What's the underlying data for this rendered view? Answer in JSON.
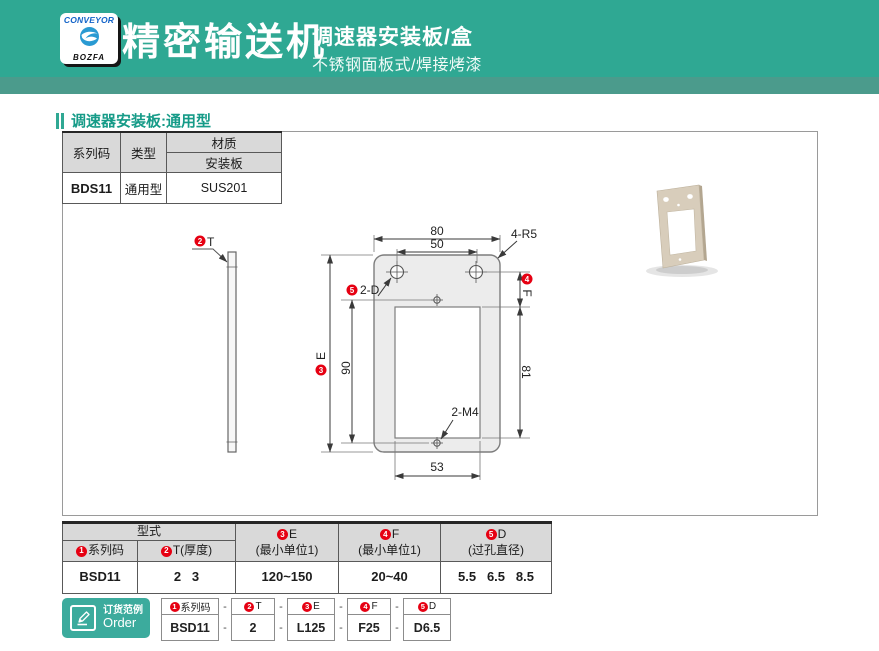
{
  "header": {
    "logo_top": "CONVEYOR",
    "logo_bottom": "BOZFA",
    "title": "精密输送机",
    "subtitle": "调速器安装板/盒",
    "tagline": "不锈钢面板式/焊接烤漆"
  },
  "section_title": "调速器安装板:通用型",
  "spec_table": {
    "h_series": "系列码",
    "h_type": "类型",
    "h_material": "材质",
    "h_plate": "安装板",
    "series": "BDS11",
    "type": "通用型",
    "material": "SUS201"
  },
  "drawing": {
    "t_num": "2",
    "t_label": "T",
    "dim80": "80",
    "dim50": "50",
    "corner": "4-R5",
    "d_num": "5",
    "d_label": "2-D",
    "e_num": "3",
    "e_label": "E",
    "f_num": "4",
    "f_label": "F",
    "dim90": "90",
    "dim81": "81",
    "thread": "2-M4",
    "dim53": "53"
  },
  "model_table": {
    "group": "型式",
    "columns": [
      {
        "num": "1",
        "label": "系列码",
        "sub": ""
      },
      {
        "num": "2",
        "label": "T(厚度)",
        "sub": ""
      },
      {
        "num": "3",
        "label": "E",
        "sub": "(最小单位1)"
      },
      {
        "num": "4",
        "label": "F",
        "sub": "(最小单位1)"
      },
      {
        "num": "5",
        "label": "D",
        "sub": "(过孔直径)"
      }
    ],
    "values": [
      "BSD11",
      "2   3",
      "120~150",
      "20~40",
      "5.5   6.5   8.5"
    ]
  },
  "order": {
    "badge_cn": "订货范例",
    "badge_en": "Order",
    "dash": "-",
    "items": [
      {
        "num": "1",
        "label": "系列码",
        "value": "BSD11"
      },
      {
        "num": "2",
        "label": "T",
        "value": "2"
      },
      {
        "num": "3",
        "label": "E",
        "value": "L125"
      },
      {
        "num": "4",
        "label": "F",
        "value": "F25"
      },
      {
        "num": "5",
        "label": "D",
        "value": "D6.5"
      }
    ]
  },
  "colors": {
    "brand_teal": "#2fa893",
    "strip_teal": "#4b9b8c",
    "accent_red": "#e60012",
    "table_header_bg": "#d9d9d9"
  }
}
